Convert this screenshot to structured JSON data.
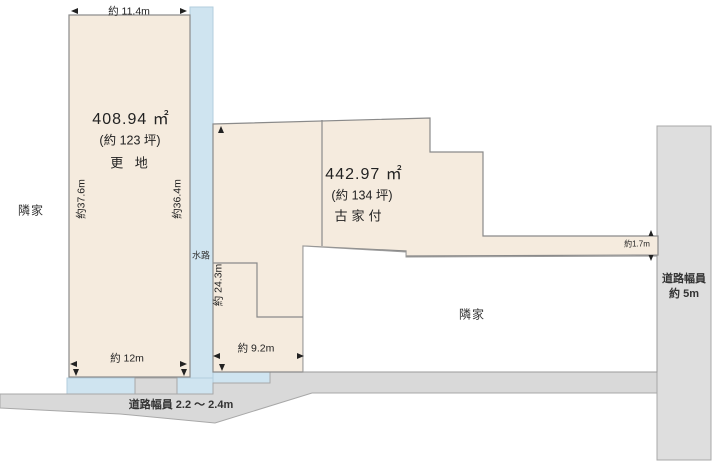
{
  "diagram": {
    "lot_left": {
      "area_m2": "408.94 ㎡",
      "area_tsubo": "(約 123 坪)",
      "status": "更 地",
      "dim_top": "約 11.4m",
      "dim_left": "約37.6m",
      "dim_right": "約36.4m",
      "dim_bottom": "約 12m"
    },
    "lot_right": {
      "area_m2": "442.97 ㎡",
      "area_tsubo": "(約 134 坪)",
      "status": "古家付",
      "dim_left": "約 24.3m",
      "dim_bottom": "約 9.2m",
      "dim_strip": "約1.7m"
    },
    "waterway_label": "水路",
    "road_bottom_label": "道路幅員 2.2 ～ 2.4m",
    "road_right_label_line1": "道路幅員",
    "road_right_label_line2": "約 5m",
    "neighbor_left": "隣家",
    "neighbor_bottom_right": "隣家",
    "colors": {
      "lot_fill": "#f5ebde",
      "water_fill": "#cfe4f0",
      "road_fill": "#d9d9d9",
      "road_right_fill": "#dedede",
      "neighbor_fill": "#ffffff",
      "border_gray": "#8a8a8a",
      "road_border": "#a8a8a8"
    }
  }
}
